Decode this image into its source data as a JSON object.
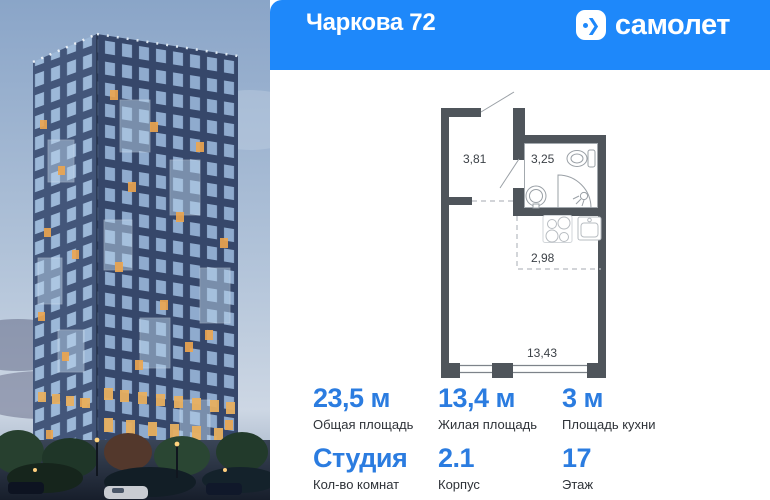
{
  "colors": {
    "header_blue": "#1e88fa",
    "value_blue": "#2b7ce0"
  },
  "header": {
    "title": "Чаркова 72",
    "brand": "самолет",
    "brand_arrow": "❯"
  },
  "photo": {
    "icon": "building-render-dusk"
  },
  "floor_plan": {
    "hallway_area": "3,81",
    "bathroom_area": "3,25",
    "kitchen_area": "2,98",
    "living_area": "13,43",
    "icons": [
      "toilet-icon",
      "washbasin-icon",
      "shower-icon",
      "stove-icon",
      "kitchen-sink-icon"
    ]
  },
  "stats": {
    "row1": [
      {
        "value": "23,5 м",
        "label": "Общая площадь"
      },
      {
        "value": "13,4 м",
        "label": "Жилая площадь"
      },
      {
        "value": "3 м",
        "label": "Площадь кухни"
      }
    ],
    "row2": [
      {
        "value": "Студия",
        "label": "Кол-во комнат"
      },
      {
        "value": "2.1",
        "label": "Корпус"
      },
      {
        "value": "17",
        "label": "Этаж"
      }
    ]
  }
}
